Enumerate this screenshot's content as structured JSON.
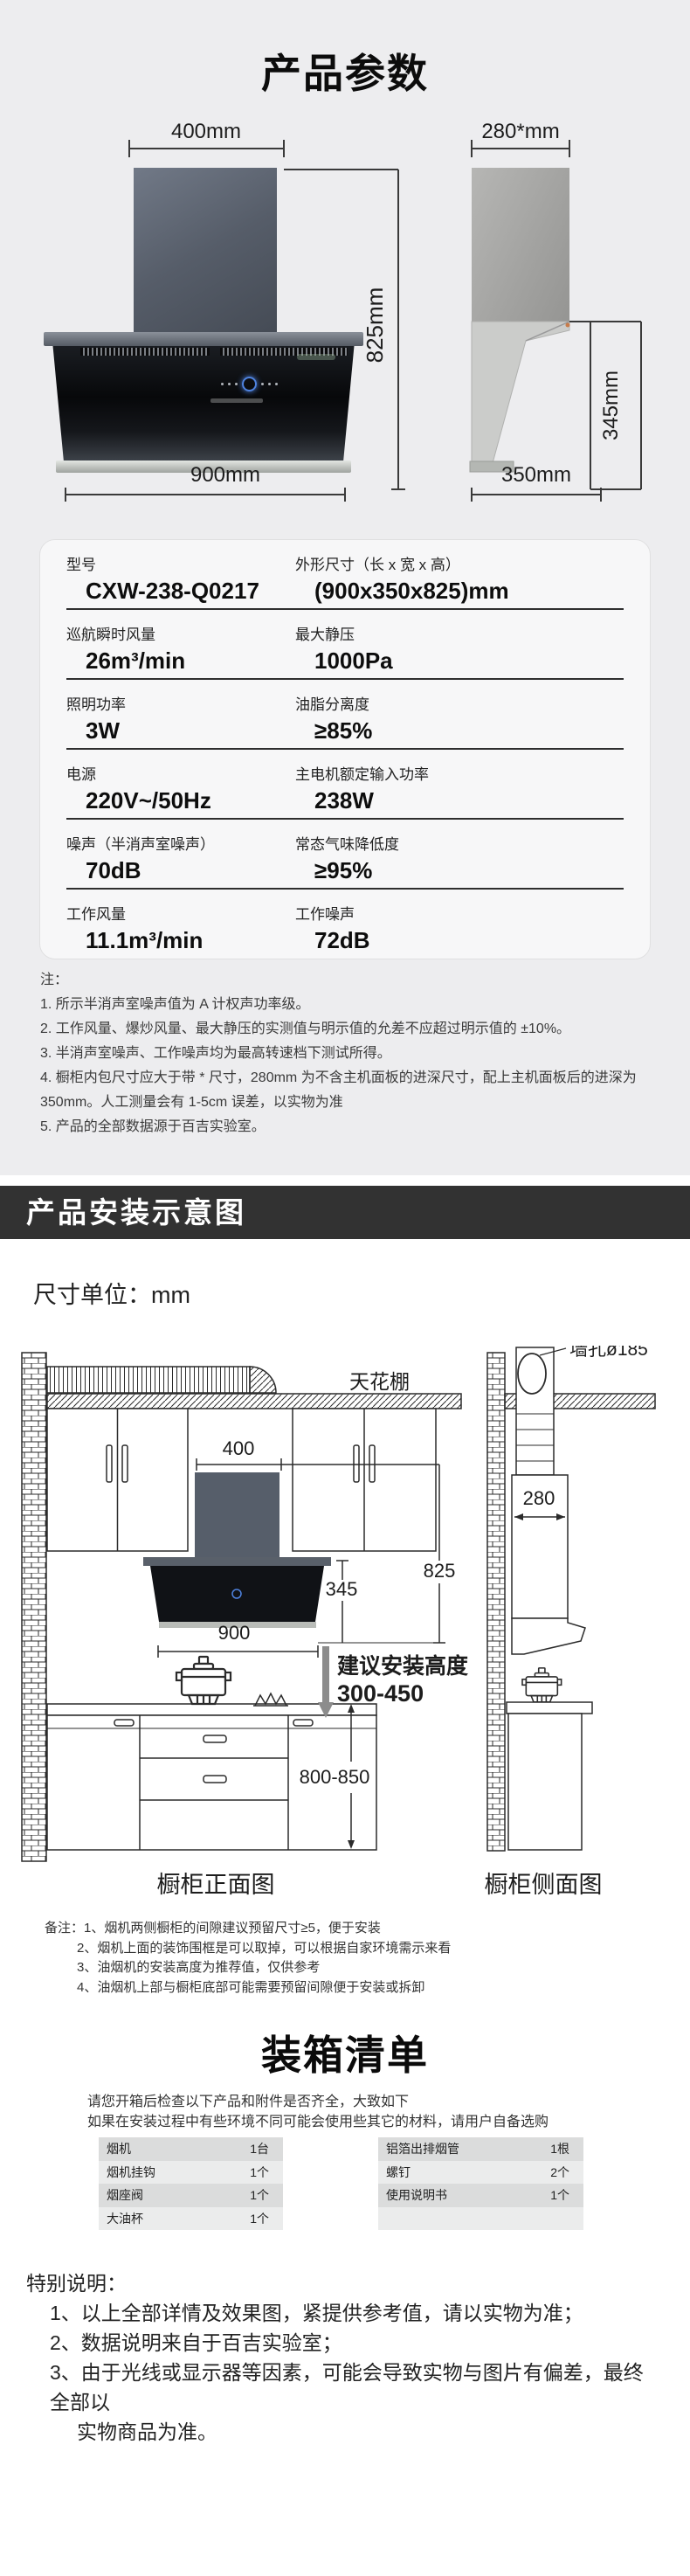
{
  "colors": {
    "page_bg": "#ededef",
    "banner_bg": "#323232",
    "accent_blue": "#4f83e0"
  },
  "product_params": {
    "title": "产品参数",
    "front_view": {
      "width_top": "400mm",
      "height": "825mm",
      "width_bottom": "900mm"
    },
    "side_view": {
      "depth_top": "280*mm",
      "height": "345mm",
      "depth_bottom": "350mm"
    }
  },
  "spec_table": {
    "rows": [
      {
        "l_label": "型号",
        "l_value": "CXW-238-Q0217",
        "r_label": "外形尺寸（长 x 宽 x 高）",
        "r_value": "(900x350x825)mm"
      },
      {
        "l_label": "巡航瞬时风量",
        "l_value": "26m³/min",
        "r_label": "最大静压",
        "r_value": "1000Pa"
      },
      {
        "l_label": "照明功率",
        "l_value": "3W",
        "r_label": "油脂分离度",
        "r_value": "≥85%"
      },
      {
        "l_label": "电源",
        "l_value": "220V~/50Hz",
        "r_label": "主电机额定输入功率",
        "r_value": "238W"
      },
      {
        "l_label": "噪声（半消声室噪声）",
        "l_value": "70dB",
        "r_label": "常态气味降低度",
        "r_value": "≥95%"
      },
      {
        "l_label": "工作风量",
        "l_value": "11.1m³/min",
        "r_label": "工作噪声",
        "r_value": "72dB"
      }
    ]
  },
  "notes": {
    "heading": "注：",
    "items": [
      "1. 所示半消声室噪声值为 A 计权声功率级。",
      "2. 工作风量、爆炒风量、最大静压的实测值与明示值的允差不应超过明示值的 ±10%。",
      "3. 半消声室噪声、工作噪声均为最高转速档下测试所得。",
      "4. 橱柜内包尺寸应大于带 * 尺寸，280mm 为不含主机面板的进深尺寸，配上主机面板后的进深为 350mm。人工测量会有 1-5cm 误差，以实物为准",
      "5. 产品的全部数据源于百吉实验室。"
    ]
  },
  "install_section": {
    "banner": "产品安装示意图",
    "unit_note": "尺寸单位：mm",
    "diagram": {
      "ceiling_label": "天花棚",
      "wall_hole_label": "墙孔ø185",
      "dim_400": "400",
      "dim_280": "280",
      "dim_825": "825",
      "dim_345": "345",
      "dim_900": "900",
      "install_height_label": "建议安装高度",
      "install_height_range": "300-450",
      "counter_height": "800-850",
      "front_caption": "橱柜正面图",
      "side_caption": "橱柜侧面图"
    },
    "remarks": [
      "备注：1、烟机两侧橱柜的间隙建议预留尺寸≥5，便于安装",
      "2、烟机上面的装饰围框是可以取掉，可以根据自家环境需示来看",
      "3、油烟机的安装高度为推荐值，仅供参考",
      "4、油烟机上部与橱柜底部可能需要预留间隙便于安装或拆卸"
    ]
  },
  "packing": {
    "title": "装箱清单",
    "intro": [
      "请您开箱后检查以下产品和附件是否齐全，大致如下",
      "如果在安装过程中有些环境不同可能会使用些其它的材料，请用户自备选购"
    ],
    "left_table": [
      {
        "item": "烟机",
        "qty": "1台"
      },
      {
        "item": "烟机挂钩",
        "qty": "1个"
      },
      {
        "item": "烟座阀",
        "qty": "1个"
      },
      {
        "item": "大油杯",
        "qty": "1个"
      }
    ],
    "right_table": [
      {
        "item": "铝箔出排烟管",
        "qty": "1根"
      },
      {
        "item": "螺钉",
        "qty": "2个"
      },
      {
        "item": "使用说明书",
        "qty": "1个"
      },
      {
        "item": "",
        "qty": ""
      }
    ]
  },
  "special": {
    "heading": "特别说明：",
    "items": [
      "1、以上全部详情及效果图，紧提供参考值，请以实物为准；",
      "2、数据说明来自于百吉实验室；",
      "3、由于光线或显示器等因素，可能会导致实物与图片有偏差，最终全部以",
      "实物商品为准。"
    ]
  }
}
